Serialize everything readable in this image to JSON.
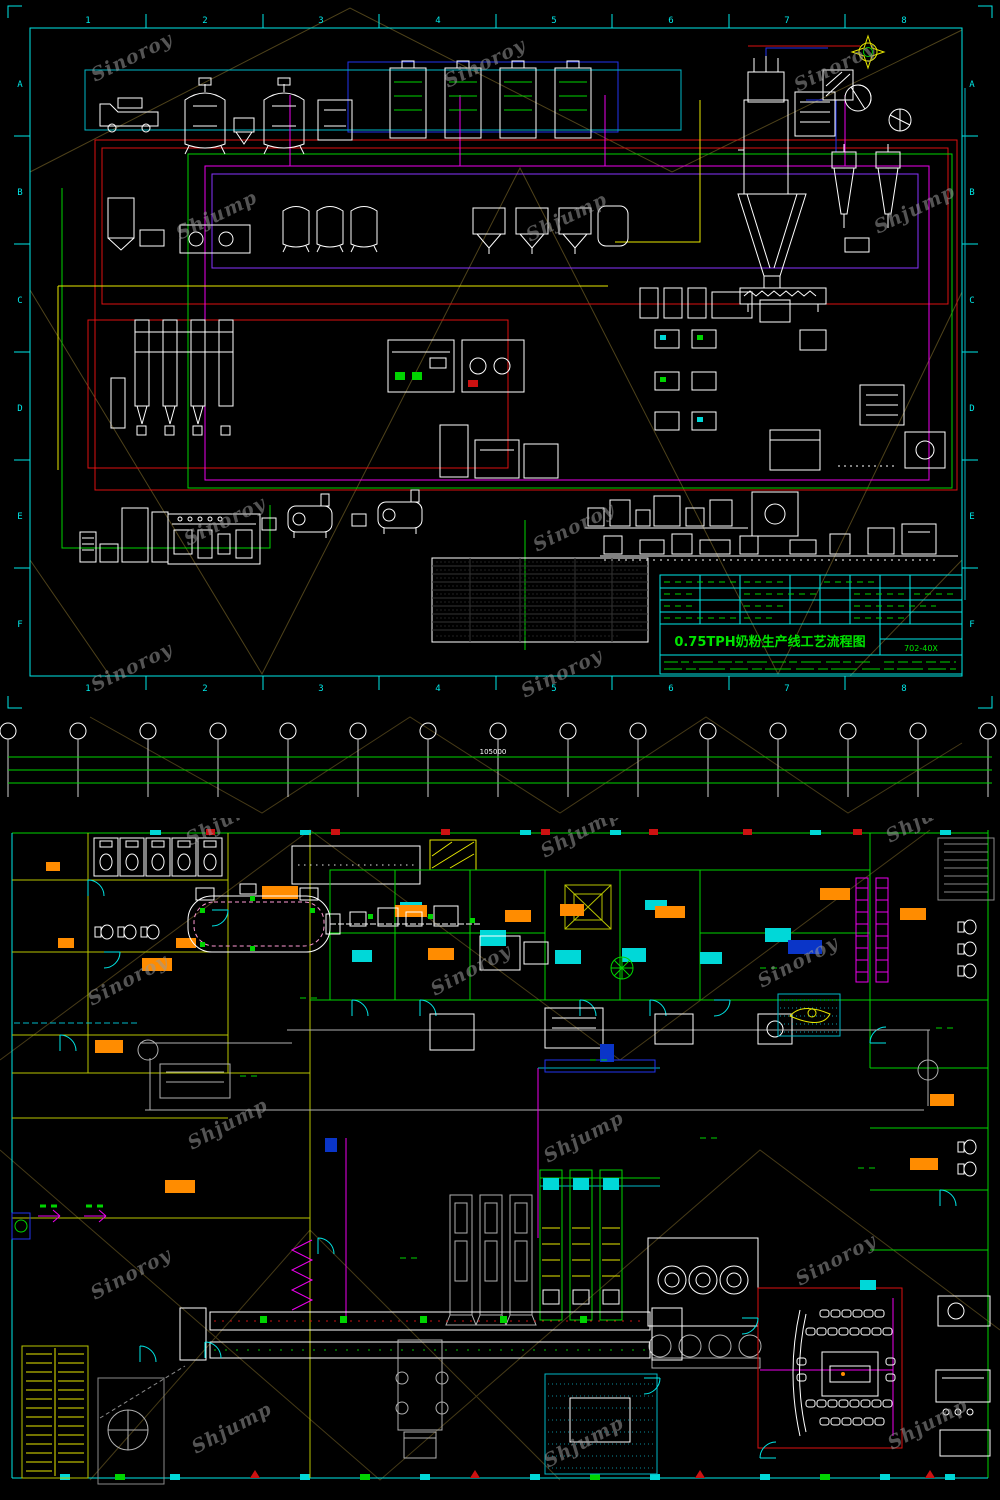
{
  "watermarks": {
    "sinoroy": "Sinoroy",
    "shjump": "Shjump"
  },
  "top_sheet": {
    "cols": [
      "1",
      "2",
      "3",
      "4",
      "5",
      "6",
      "7",
      "8"
    ],
    "rows": [
      "A",
      "B",
      "C",
      "D",
      "E",
      "F"
    ],
    "title_block": {
      "title": "0.75TPH奶粉生产线工艺流程图",
      "drawing_no": "702-40X"
    }
  },
  "axis_strip": {
    "cols": [
      "1",
      "2",
      "3",
      "4",
      "5",
      "6",
      "7",
      "8",
      "9",
      "10",
      "11",
      "12",
      "13",
      "14",
      "15"
    ],
    "total_dim": "105000",
    "bay_dim": "7500",
    "sub_dim": "700",
    "sub_dim_b": "3500",
    "sub_dim_c": "4000",
    "edge_dim": "4800"
  },
  "colors": {
    "background": "#000000",
    "frame_cyan": "#00e8e8",
    "line_green": "#00d400",
    "line_red": "#dd1111",
    "line_magenta": "#ee00ee",
    "line_yellow": "#e8e800",
    "equipment_white": "#ffffff",
    "conveyor_gray": "#b0b0b0",
    "furniture_orange": "#ff8c00",
    "title_green": "#00e400",
    "fold_olive": "#57491d",
    "wall_slate": "#44587e"
  }
}
